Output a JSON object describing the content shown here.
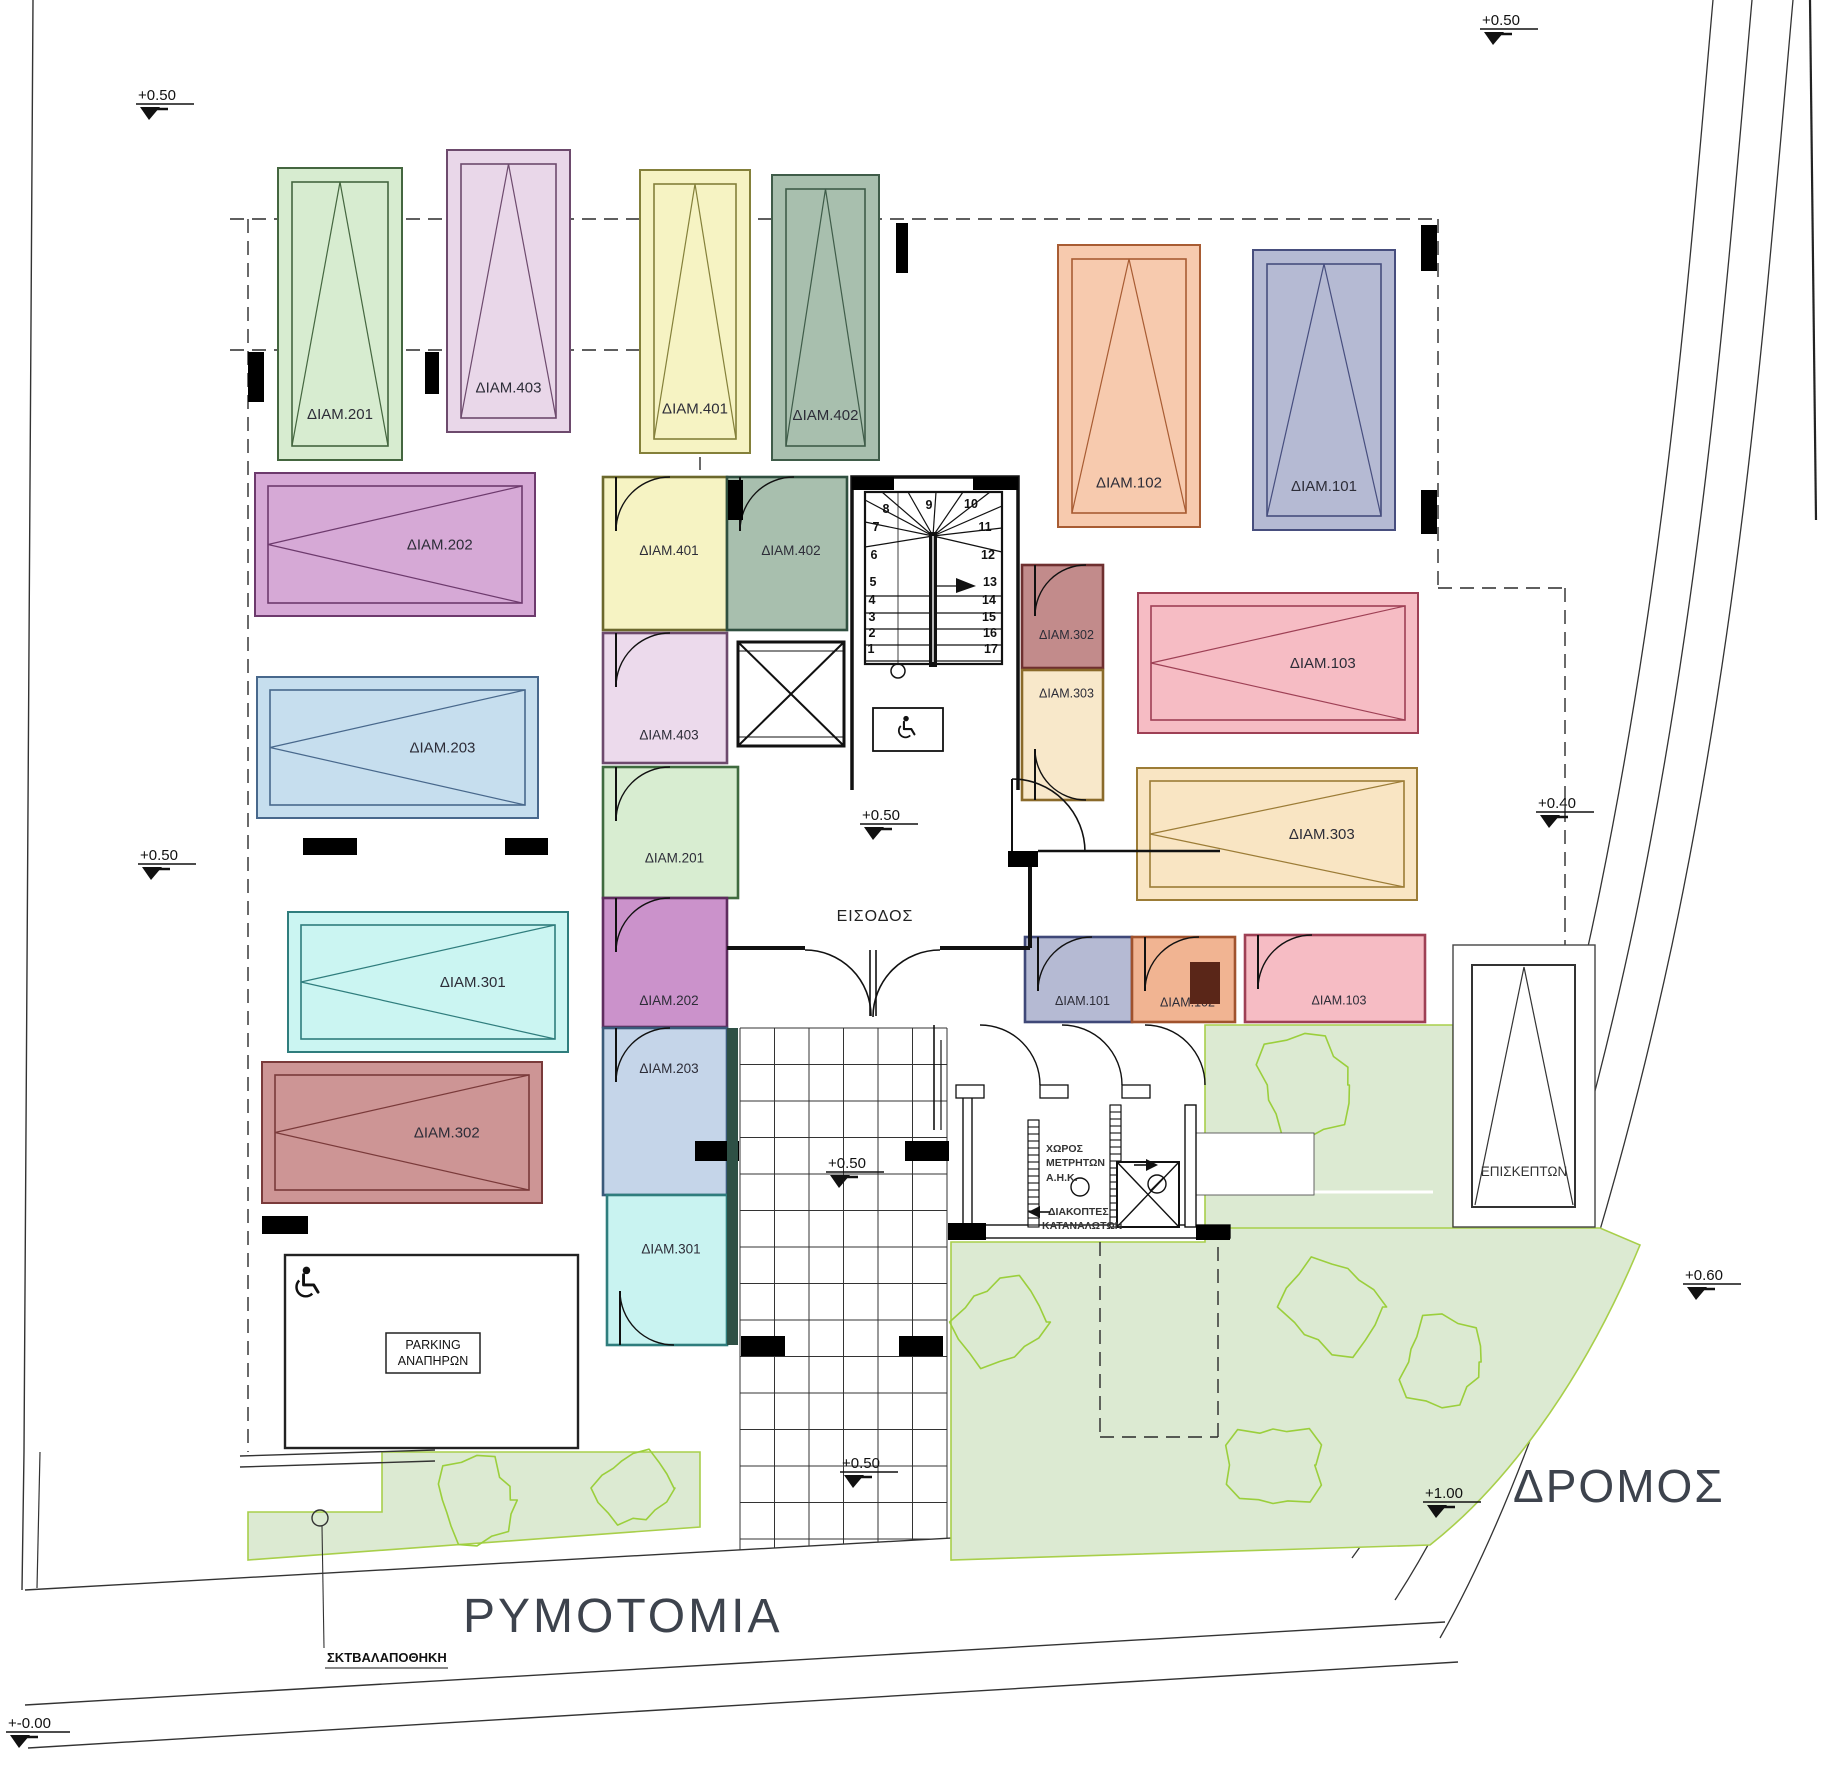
{
  "site": {
    "street_label": "ΡΥΜΟΤΟΜΙΑ",
    "road_label": "ΔΡΟΜΟΣ",
    "garbage_label": "ΣΚΤΒΑΛΑΠΟΘΗΚΗ"
  },
  "lobby": {
    "entrance_label": "ΕΙΣΟΔΟΣ"
  },
  "colors": {
    "green_area": "#dcead2",
    "green_border": "#a8cf4a",
    "tree_outline": "#9bcf3c",
    "wall": "#111111"
  },
  "levels": [
    {
      "value": "+0.50"
    },
    {
      "value": "+0.50"
    },
    {
      "value": "+0.50"
    },
    {
      "value": "+0.50"
    },
    {
      "value": "+0.40"
    },
    {
      "value": "+0.60"
    },
    {
      "value": "+0.50"
    },
    {
      "value": "+0.50"
    },
    {
      "value": "+1.00"
    },
    {
      "value": "+-0.00"
    }
  ],
  "parking": {
    "vertical": [
      {
        "label": "ΔΙΑΜ.201",
        "fill": "#d7ecd0",
        "stroke": "#44663f"
      },
      {
        "label": "ΔΙΑΜ.403",
        "fill": "#e9d7e9",
        "stroke": "#6d4a6d"
      },
      {
        "label": "ΔΙΑΜ.401",
        "fill": "#f6f3c3",
        "stroke": "#84803a"
      },
      {
        "label": "ΔΙΑΜ.402",
        "fill": "#a8bfae",
        "stroke": "#3f5c49"
      },
      {
        "label": "ΔΙΑΜ.102",
        "fill": "#f7caae",
        "stroke": "#a85c33"
      },
      {
        "label": "ΔΙΑΜ.101",
        "fill": "#b5bad3",
        "stroke": "#474e7e"
      }
    ],
    "horizontal": [
      {
        "label": "ΔΙΑΜ.202",
        "fill": "#d6a9d6",
        "stroke": "#6d3a6d"
      },
      {
        "label": "ΔΙΑΜ.203",
        "fill": "#c6deee",
        "stroke": "#48688c"
      },
      {
        "label": "ΔΙΑΜ.301",
        "fill": "#cbf5f2",
        "stroke": "#2f7d7d"
      },
      {
        "label": "ΔΙΑΜ.302",
        "fill": "#cd9595",
        "stroke": "#7a3a3a"
      },
      {
        "label": "ΔΙΑΜ.103",
        "fill": "#f6bcc4",
        "stroke": "#9e4055"
      },
      {
        "label": "ΔΙΑΜ.303",
        "fill": "#f9e5c3",
        "stroke": "#9c7c36"
      }
    ],
    "visitor": {
      "label": "ΕΠΙΣΚΕΠΤΩΝ",
      "fill": "#ffffff",
      "stroke": "#3a3a3a"
    },
    "disabled": {
      "line1": "PARKING",
      "line2": "ΑΝΑΠΗΡΩΝ"
    }
  },
  "storage": {
    "west": [
      {
        "label": "ΔΙΑΜ.401",
        "fill": "#f6f3c3",
        "stroke": "#6b682c"
      },
      {
        "label": "ΔΙΑΜ.402",
        "fill": "#a8bfae",
        "stroke": "#2f4f3f"
      },
      {
        "label": "ΔΙΑΜ.403",
        "fill": "#ecdaec",
        "stroke": "#6d4a6d"
      },
      {
        "label": "ΔΙΑΜ.201",
        "fill": "#d8edd1",
        "stroke": "#3f6b3f"
      },
      {
        "label": "ΔΙΑΜ.202",
        "fill": "#cb92cb",
        "stroke": "#5e2c5e"
      },
      {
        "label": "ΔΙΑΜ.203",
        "fill": "#c5d5e9",
        "stroke": "#3a5a7a"
      },
      {
        "label": "ΔΙΑΜ.301",
        "fill": "#c9f3f1",
        "stroke": "#2f7d7d"
      }
    ],
    "east": [
      {
        "label": "ΔΙΑΜ.302",
        "fill": "#c28b8b",
        "stroke": "#6e2f2f"
      },
      {
        "label": "ΔΙΑΜ.303",
        "fill": "#f8e8ca",
        "stroke": "#8a6a2a"
      }
    ],
    "south": [
      {
        "label": "ΔΙΑΜ.101",
        "fill": "#b5bad3",
        "stroke": "#3f4878"
      },
      {
        "label": "ΔΙΑΜ.102",
        "fill": "#f1b492",
        "stroke": "#a0522d"
      },
      {
        "label": "ΔΙΑΜ.103",
        "fill": "#f6bcc4",
        "stroke": "#9e4055"
      }
    ]
  },
  "stair": {
    "steps": [
      "1",
      "2",
      "3",
      "4",
      "5",
      "6",
      "7",
      "8",
      "9",
      "10",
      "11",
      "12",
      "13",
      "14",
      "15",
      "16",
      "17"
    ]
  },
  "meter_room": {
    "line1": "ΧΩΡΟΣ",
    "line2": "ΜΕΤΡΗΤΩΝ",
    "line3": "Α.Η.Κ.",
    "switch_line1": "ΔΙΑΚΟΠΤΕΣ",
    "switch_line2": "ΚΑΤΑΝΑΛΩΤΩΝ"
  }
}
